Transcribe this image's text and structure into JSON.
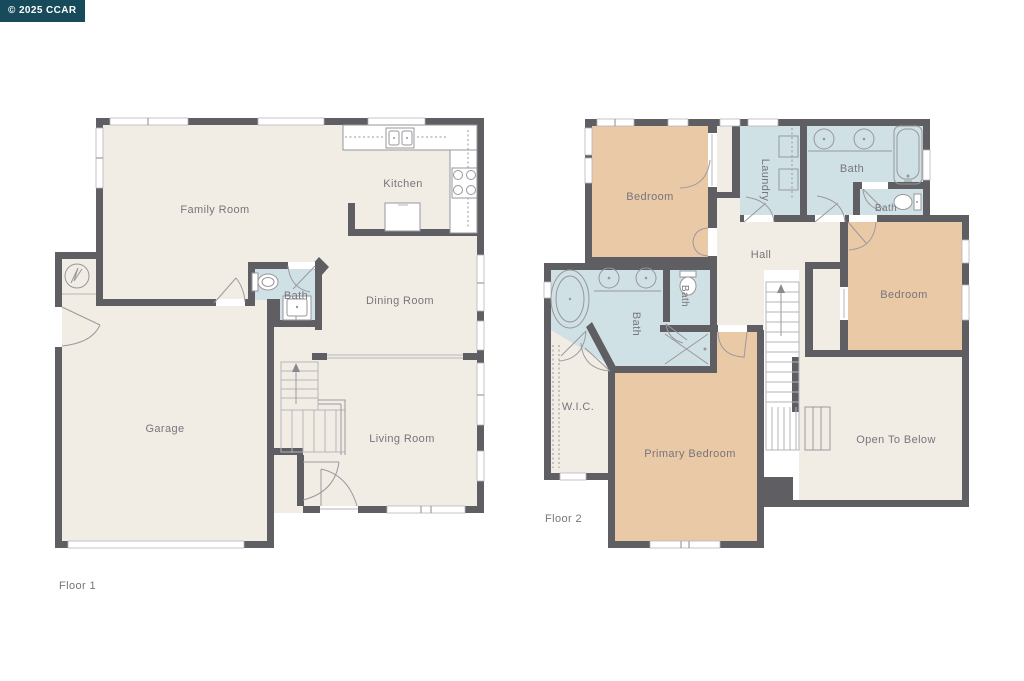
{
  "watermark": {
    "text": "© 2025 CCAR"
  },
  "palette": {
    "wall": "#5e5e63",
    "room": "#f1ede5",
    "bath": "#cfe1e4",
    "bedroom": "#eac9a6",
    "label": "#77757c",
    "line": "#97969b",
    "window_line": "#b6b5ba",
    "watermark_bg": "#174a5b",
    "watermark_fg": "#ffffff",
    "background": "#ffffff"
  },
  "floor1": {
    "label": "Floor 1",
    "rooms": {
      "family_room": "Family Room",
      "kitchen": "Kitchen",
      "dining_room": "Dining Room",
      "bath": "Bath",
      "garage": "Garage",
      "living_room": "Living Room"
    }
  },
  "floor2": {
    "label": "Floor 2",
    "rooms": {
      "bedroom_left": "Bedroom",
      "laundry": "Laundry",
      "bath_hall": "Bath",
      "bath_small": "Bath",
      "hall": "Hall",
      "bedroom_right": "Bedroom",
      "bath_primary": "Bath",
      "bath_toilet": "Bath",
      "wic": "W.I.C.",
      "primary_bedroom": "Primary Bedroom",
      "open_to_below": "Open To Below"
    }
  }
}
